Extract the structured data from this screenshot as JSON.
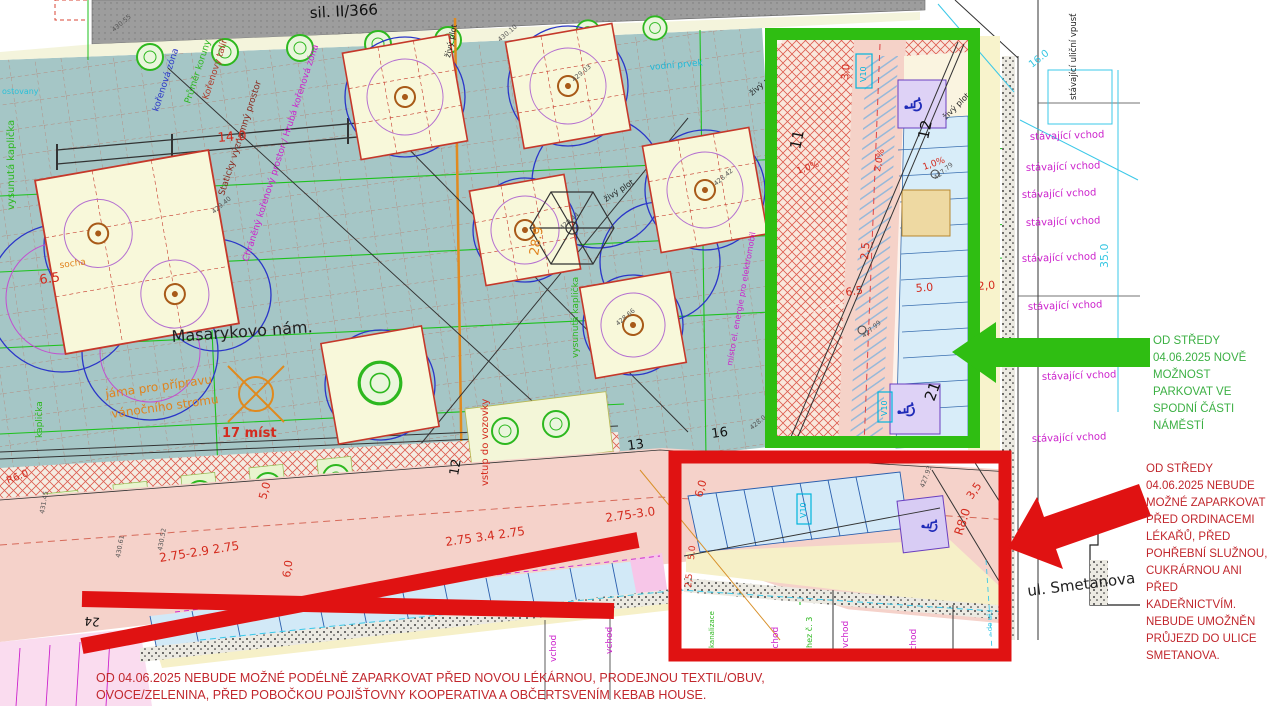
{
  "map": {
    "street_top": "sil. II/366",
    "square_name": "Masarykovo nám.",
    "street_right": "ul. Smetanova",
    "pit_line1": "jáma pro přípravu",
    "pit_line2": "vánočního stromu",
    "spots": "17 míst",
    "entrance": "stávající vchod",
    "inlet": "stávající uliční vpusť",
    "water": "vodní prvek",
    "hedge": "živý plot",
    "chapel_left": "vysunutá kaplička",
    "chapel_small": "kaplička",
    "root_zone": "kořenová zóna",
    "crown_dia": "Průměr koruny",
    "root_plate": "Kořenový talíř",
    "static_zone": "Staticky významný prostor",
    "protected_zone": "Chráněný kořenový prostor / Hrubá kořenová zóna",
    "statue": "socha",
    "road_entry": "vstup do vozovky",
    "ev_spot": "místo el. energie pro elektromobil",
    "sewer": "kanalizace",
    "house3": "hez č. 3",
    "to_street": "- do ul.",
    "vchod": "vchod",
    "v10": "V10",
    "partial_top_left": "ostovany",
    "numbers": {
      "n11": "11",
      "n12": "12",
      "n13": "13",
      "n16": "16",
      "n21": "21",
      "n24": "24",
      "n7": "7",
      "n9": "9"
    },
    "dims": {
      "d14": "14.0",
      "d65": "6.5",
      "d60": "6,0",
      "d50": "5.0",
      "d50b": "5,0",
      "d25": "2,5",
      "d20": "2,0",
      "d30": "3,0",
      "d35": "3,5",
      "r6": "R6.0",
      "r8": "R8.0",
      "row_left": "2.75-2.9 2.75",
      "row_mid": "2.75 3.4 2.75",
      "row_right": "2.75-3.0",
      "pct1": "1,0%",
      "pct2": "2,0%",
      "w289": "28.9",
      "len35": "35.0",
      "len16": "16.0"
    },
    "elevations": [
      "430.55",
      "430.10",
      "429.03",
      "428.42",
      "429.44",
      "428.66",
      "429.40",
      "427.79",
      "427.99",
      "428.04",
      "427.93",
      "431.45",
      "430.61",
      "430.52"
    ]
  },
  "annotations": {
    "green_note": {
      "color": "#3cb044",
      "lines": [
        "OD STŘEDY",
        "04.06.2025 NOVĚ",
        "MOŽNOST",
        "PARKOVAT VE",
        "SPODNÍ ČÁSTI",
        "NÁMĚSTÍ"
      ]
    },
    "red_note": {
      "color": "#c1272d",
      "lines": [
        "OD STŘEDY",
        "04.06.2025 NEBUDE",
        "MOŽNÉ ZAPARKOVAT",
        "PŘED ORDINACEMI",
        "LÉKAŘŮ, PŘED",
        "POHŘEBNÍ SLUŽNOU,",
        "CUKRÁRNOU ANI",
        "PŘED",
        "KADEŘNICTVÍM.",
        "NEBUDE UMOŽNĚN",
        "PRŮJEZD DO ULICE",
        "SMETANOVA."
      ]
    },
    "bottom_note": {
      "line1": "OD 04.06.2025 NEBUDE MOŽNÉ PODÉLNĚ ZAPARKOVAT PŘED NOVOU LÉKÁRNOU, PRODEJNOU TEXTIL/OBUV,",
      "line2": "OVOCE/ZELENINA, PŘED POBOČKOU POJIŠŤOVNY KOOPERATIVA A OBČERTSVENÍM KEBAB HOUSE."
    },
    "highlight_green": "#2fbe12",
    "highlight_red": "#e01212"
  }
}
